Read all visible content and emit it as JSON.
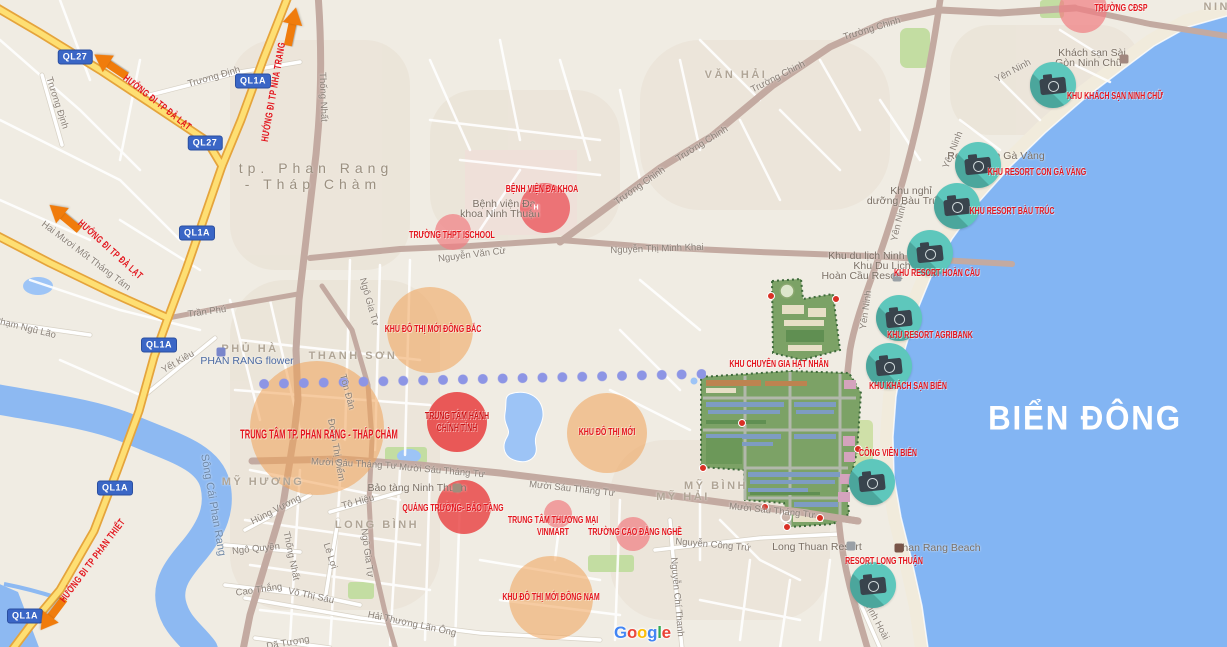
{
  "sea_label": {
    "t": "BIỂN ĐÔNG"
  },
  "city_label": {
    "line1": "tp. Phan Rang",
    "line2": "- Tháp Chàm"
  },
  "google_logo": {
    "letters": [
      {
        "ch": "G",
        "c": "#4285F4"
      },
      {
        "ch": "o",
        "c": "#EA4335"
      },
      {
        "ch": "o",
        "c": "#FBBC05"
      },
      {
        "ch": "g",
        "c": "#4285F4"
      },
      {
        "ch": "l",
        "c": "#34A853"
      },
      {
        "ch": "e",
        "c": "#EA4335"
      }
    ]
  },
  "badges": [
    {
      "t": "QL27",
      "x": 75,
      "y": 57
    },
    {
      "t": "QL27",
      "x": 205,
      "y": 143
    },
    {
      "t": "QL1A",
      "x": 253,
      "y": 81
    },
    {
      "t": "QL1A",
      "x": 197,
      "y": 233
    },
    {
      "t": "QL1A",
      "x": 159,
      "y": 345
    },
    {
      "t": "QL1A",
      "x": 115,
      "y": 488
    },
    {
      "t": "QL1A",
      "x": 25,
      "y": 616
    }
  ],
  "arrows": [
    {
      "x": 110,
      "y": 65,
      "r": -146
    },
    {
      "x": 292,
      "y": 26,
      "r": -78
    },
    {
      "x": 64,
      "y": 217,
      "r": -140
    },
    {
      "x": 52,
      "y": 615,
      "r": 127
    }
  ],
  "direction_signs": [
    {
      "t": "HƯỚNG ĐI TP ĐÀ LẠT",
      "x": 157,
      "y": 103,
      "r": 38
    },
    {
      "t": "HƯỚNG ĐI TP NHA TRANG",
      "x": 274,
      "y": 92,
      "r": -80
    },
    {
      "t": "HƯỚNG ĐI TP ĐÀ LẠT",
      "x": 110,
      "y": 250,
      "r": 42
    },
    {
      "t": "HƯỚNG ĐI TP PHAN THIẾT",
      "x": 93,
      "y": 561,
      "r": -53
    }
  ],
  "red_labels": [
    {
      "lines": [
        "TRƯỜNG CĐSP"
      ],
      "x": 1121,
      "y": 9,
      "fs": 10
    },
    {
      "lines": [
        "BỆNH VIỆN ĐA KHOA"
      ],
      "x": 542,
      "y": 190,
      "fs": 10
    },
    {
      "lines": [
        "TRƯỜNG THPT ISCHOOL"
      ],
      "x": 452,
      "y": 236,
      "fs": 10
    },
    {
      "lines": [
        "KHU ĐÔ THỊ MỚI ĐÔNG BẮC"
      ],
      "x": 433,
      "y": 330,
      "fs": 10
    },
    {
      "lines": [
        "TRUNG TÂM HÀNH",
        "CHÍNH TỈNH"
      ],
      "x": 457,
      "y": 423,
      "fs": 10,
      "c": "#cc1416"
    },
    {
      "lines": [
        "TRUNG TÂM TP. PHAN RANG - THÁP CHÀM"
      ],
      "x": 319,
      "y": 434,
      "fs": 13
    },
    {
      "lines": [
        "KHU ĐÔ THỊ MỚI"
      ],
      "x": 607,
      "y": 433,
      "fs": 10
    },
    {
      "lines": [
        "KHU CHUYÊN GIA HẠT NHÂN"
      ],
      "x": 779,
      "y": 365,
      "fs": 10
    },
    {
      "lines": [
        "QUẢNG TRƯỜNG- BẢO TÀNG"
      ],
      "x": 453,
      "y": 509,
      "fs": 10
    },
    {
      "lines": [
        "TRUNG TÂM THƯƠNG MẠI",
        "VINMART"
      ],
      "x": 553,
      "y": 527,
      "fs": 10
    },
    {
      "lines": [
        "TRƯỜNG CAO ĐẲNG NGHỀ"
      ],
      "x": 635,
      "y": 533,
      "fs": 10
    },
    {
      "lines": [
        "KHU ĐÔ THỊ MỚI ĐÔNG NAM"
      ],
      "x": 551,
      "y": 598,
      "fs": 10
    }
  ],
  "camera_spots": [
    {
      "label": "KHU KHÁCH SẠN NINH CHỮ",
      "cx": 1053,
      "cy": 85,
      "lx": 1115,
      "ly": 97
    },
    {
      "label": "KHU RESORT CON GÀ VÀNG",
      "cx": 978,
      "cy": 165,
      "lx": 1037,
      "ly": 173
    },
    {
      "label": "KHU RESORT BÀU TRÚC",
      "cx": 957,
      "cy": 206,
      "lx": 1012,
      "ly": 212
    },
    {
      "label": "KHU RESORT HOÀN CẦU",
      "cx": 930,
      "cy": 253,
      "lx": 937,
      "ly": 274
    },
    {
      "label": "KHU RESORT AGRIBANK",
      "cx": 899,
      "cy": 318,
      "lx": 930,
      "ly": 336
    },
    {
      "label": "KHU KHÁCH SẠN BIỂN",
      "cx": 889,
      "cy": 366,
      "lx": 908,
      "ly": 387
    },
    {
      "label": "CÔNG VIÊN BIỂN",
      "cx": 872,
      "cy": 482,
      "lx": 888,
      "ly": 454
    },
    {
      "label": "RESORT LONG THUẬN",
      "cx": 873,
      "cy": 585,
      "lx": 884,
      "ly": 562
    }
  ],
  "circles": [
    {
      "x": 430,
      "y": 330,
      "r": 43,
      "c": "rgba(241,163,87,0.55)"
    },
    {
      "x": 317,
      "y": 428,
      "r": 67,
      "c": "rgba(241,163,87,0.55)"
    },
    {
      "x": 607,
      "y": 433,
      "r": 40,
      "c": "rgba(241,163,87,0.55)"
    },
    {
      "x": 551,
      "y": 598,
      "r": 42,
      "c": "rgba(241,163,87,0.55)"
    },
    {
      "x": 1083,
      "y": 9,
      "r": 24,
      "c": "rgba(240,128,131,0.72)"
    },
    {
      "x": 453,
      "y": 232,
      "r": 18,
      "c": "rgba(240,128,131,0.72)"
    },
    {
      "x": 558,
      "y": 514,
      "r": 14,
      "c": "rgba(240,128,131,0.72)"
    },
    {
      "x": 633,
      "y": 534,
      "r": 17,
      "c": "rgba(240,128,131,0.72)"
    },
    {
      "x": 545,
      "y": 208,
      "r": 25,
      "c": "rgba(235,88,92,0.8)"
    },
    {
      "x": 457,
      "y": 422,
      "r": 30,
      "c": "rgba(232,62,62,0.85)"
    },
    {
      "x": 464,
      "y": 507,
      "r": 27,
      "c": "rgba(232,62,62,0.8)"
    }
  ],
  "area_labels": [
    {
      "t": "PHỦ HÀ",
      "x": 250,
      "y": 349
    },
    {
      "t": "THANH SƠN",
      "x": 353,
      "y": 356
    },
    {
      "t": "MỸ HƯƠNG",
      "x": 263,
      "y": 482
    },
    {
      "t": "LONG BÌNH",
      "x": 377,
      "y": 525
    },
    {
      "t": "MỸ HẢI",
      "x": 683,
      "y": 497
    },
    {
      "t": "MỸ BÌNH",
      "x": 716,
      "y": 486
    },
    {
      "t": "VĂN HẢI",
      "x": 736,
      "y": 75
    },
    {
      "t": "NINH",
      "x": 1222,
      "y": 7
    }
  ],
  "poi_labels": [
    {
      "t": "Bệnh viện Đa",
      "x": 504,
      "y": 204
    },
    {
      "t": "khoa Ninh Thuận",
      "x": 500,
      "y": 214
    },
    {
      "t": "Khách sạn Sài",
      "x": 1092,
      "y": 53
    },
    {
      "t": "Gòn Ninh Chữ",
      "x": 1089,
      "y": 63
    },
    {
      "t": "Resort Con Gà Vàng",
      "x": 996,
      "y": 156
    },
    {
      "t": "Khu nghỉ",
      "x": 911,
      "y": 191
    },
    {
      "t": "dưỡng Bàu Trúc",
      "x": 905,
      "y": 201
    },
    {
      "t": "Khu du lịch Ninh Chữ",
      "x": 878,
      "y": 256
    },
    {
      "t": "Khu Du Lịch",
      "x": 882,
      "y": 266
    },
    {
      "t": "Hoàn Cầu Resort",
      "x": 862,
      "y": 276
    },
    {
      "t": "Long Thuan Resort",
      "x": 817,
      "y": 547
    },
    {
      "t": "Phan Rang Beach",
      "x": 938,
      "y": 548
    },
    {
      "t": "Bảo tàng Ninh Thuận",
      "x": 417,
      "y": 488
    },
    {
      "t": "PHAN RANG flower",
      "x": 247,
      "y": 361,
      "c": "#4a69a2"
    }
  ],
  "street_labels": [
    {
      "t": "Trương Định",
      "x": 214,
      "y": 77,
      "r": -16
    },
    {
      "t": "Trương Định",
      "x": 57,
      "y": 103,
      "r": 72
    },
    {
      "t": "Hai Mươi Mốt Tháng Tám",
      "x": 86,
      "y": 256,
      "r": 37
    },
    {
      "t": "Phạm Ngũ Lão",
      "x": 25,
      "y": 328,
      "r": 14
    },
    {
      "t": "Trần Phú",
      "x": 207,
      "y": 312,
      "r": -8
    },
    {
      "t": "Yết Kiêu",
      "x": 178,
      "y": 362,
      "r": -30
    },
    {
      "t": "Thống Nhất",
      "x": 323,
      "y": 97,
      "r": 88
    },
    {
      "t": "Thống Nhất",
      "x": 291,
      "y": 556,
      "r": 78
    },
    {
      "t": "Ngô Gia Tự",
      "x": 369,
      "y": 302,
      "r": 74
    },
    {
      "t": "Ngô Gia Tự",
      "x": 367,
      "y": 553,
      "r": 82
    },
    {
      "t": "Tôn Đản",
      "x": 347,
      "y": 392,
      "r": 75
    },
    {
      "t": "Đoàn Thị Điểm",
      "x": 336,
      "y": 450,
      "r": 80
    },
    {
      "t": "Hùng Vương",
      "x": 276,
      "y": 510,
      "r": -27
    },
    {
      "t": "Ngô Quyền",
      "x": 256,
      "y": 549,
      "r": -6
    },
    {
      "t": "Cao Thắng",
      "x": 259,
      "y": 590,
      "r": -8
    },
    {
      "t": "Võ Thị Sáu",
      "x": 311,
      "y": 596,
      "r": 12
    },
    {
      "t": "Lê Lợi",
      "x": 330,
      "y": 556,
      "r": 72
    },
    {
      "t": "Tô Hiệu",
      "x": 358,
      "y": 502,
      "r": -15
    },
    {
      "t": "Dã Tượng",
      "x": 288,
      "y": 643,
      "r": -10
    },
    {
      "t": "Hải Thượng Lãn Ông",
      "x": 412,
      "y": 624,
      "r": 12
    },
    {
      "t": "Nguyễn Công Trứ",
      "x": 713,
      "y": 545,
      "r": 5
    },
    {
      "t": "Nguyễn Chí Thanh",
      "x": 677,
      "y": 597,
      "r": 85
    },
    {
      "t": "Trịnh Hoài",
      "x": 876,
      "y": 620,
      "r": 62
    },
    {
      "t": "Nguyễn Văn Cừ",
      "x": 472,
      "y": 255,
      "r": -7
    },
    {
      "t": "Nguyễn Thị Minh Khai",
      "x": 657,
      "y": 249,
      "r": -2
    },
    {
      "t": "Trường Chinh",
      "x": 640,
      "y": 186,
      "r": -35
    },
    {
      "t": "Trường Chinh",
      "x": 702,
      "y": 144,
      "r": -32
    },
    {
      "t": "Trường Chinh",
      "x": 778,
      "y": 77,
      "r": -27
    },
    {
      "t": "Trường Chinh",
      "x": 872,
      "y": 29,
      "r": -17
    },
    {
      "t": "Yên Ninh",
      "x": 1013,
      "y": 71,
      "r": -28
    },
    {
      "t": "Yên Ninh",
      "x": 953,
      "y": 150,
      "r": -68
    },
    {
      "t": "Yên Ninh",
      "x": 899,
      "y": 222,
      "r": -76
    },
    {
      "t": "Yên Ninh",
      "x": 866,
      "y": 310,
      "r": -82
    },
    {
      "t": "Mười Sáu Tháng Tư",
      "x": 354,
      "y": 464,
      "r": 3
    },
    {
      "t": "Mười Sáu Tháng Tư",
      "x": 442,
      "y": 471,
      "r": 5
    },
    {
      "t": "Mười Sáu Tháng Tư",
      "x": 572,
      "y": 489,
      "r": 6
    },
    {
      "t": "Mười Sáu Tháng Tư",
      "x": 772,
      "y": 511,
      "r": 6
    },
    {
      "t": "Sông Cái Phan Rang",
      "x": 213,
      "y": 505,
      "r": 80,
      "c": "#6f88a6",
      "fs": 11
    }
  ],
  "map_pins": [
    {
      "x": 771,
      "y": 296
    },
    {
      "x": 836,
      "y": 299
    },
    {
      "x": 742,
      "y": 423
    },
    {
      "x": 765,
      "y": 507
    },
    {
      "x": 820,
      "y": 518
    },
    {
      "x": 858,
      "y": 449
    },
    {
      "x": 787,
      "y": 527
    },
    {
      "x": 703,
      "y": 468
    }
  ],
  "poi_icons": [
    {
      "t": "H",
      "x": 536,
      "y": 208,
      "c": "#ef8a8e",
      "name": "hospital-icon"
    },
    {
      "t": "",
      "x": 221,
      "y": 352,
      "c": "#7986cb",
      "name": "flower-icon"
    },
    {
      "t": "",
      "x": 1124,
      "y": 59,
      "c": "#a1887f",
      "name": "hotel-icon"
    },
    {
      "t": "",
      "x": 897,
      "y": 277,
      "c": "#9aa0a6",
      "name": "resort-icon"
    },
    {
      "t": "",
      "x": 457,
      "y": 488,
      "c": "#9e8f7d",
      "name": "museum-icon"
    },
    {
      "t": "",
      "x": 851,
      "y": 546,
      "c": "#9aa0a6",
      "name": "resort-icon"
    },
    {
      "t": "",
      "x": 899,
      "y": 548,
      "c": "#795548",
      "name": "beach-icon"
    }
  ]
}
